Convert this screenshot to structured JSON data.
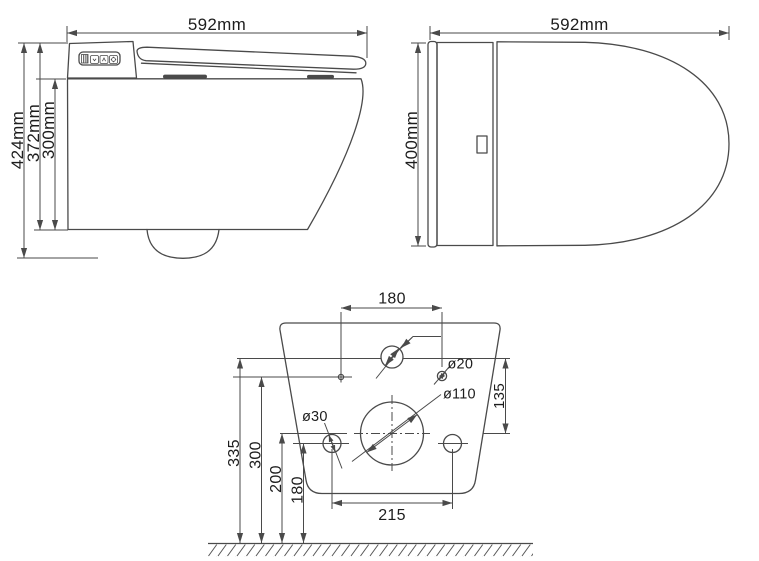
{
  "drawing": {
    "side_view": {
      "width": "592mm",
      "height_total": "424mm",
      "height_upper": "372mm",
      "height_body": "300mm"
    },
    "top_view": {
      "length": "592mm",
      "width": "400mm"
    },
    "wall_template": {
      "span_top": "180",
      "span_bottom": "215",
      "dia_small_hole": "ø20",
      "dia_outlet": "ø110",
      "dia_fixing_hole": "ø30",
      "offset_vertical": "135",
      "height_1": "335",
      "height_2": "300",
      "height_3": "200",
      "height_4": "180"
    }
  },
  "colors": {
    "plate_fill": "#ebebeb",
    "line": "#4a4a4a",
    "text": "#1d1d1d"
  }
}
